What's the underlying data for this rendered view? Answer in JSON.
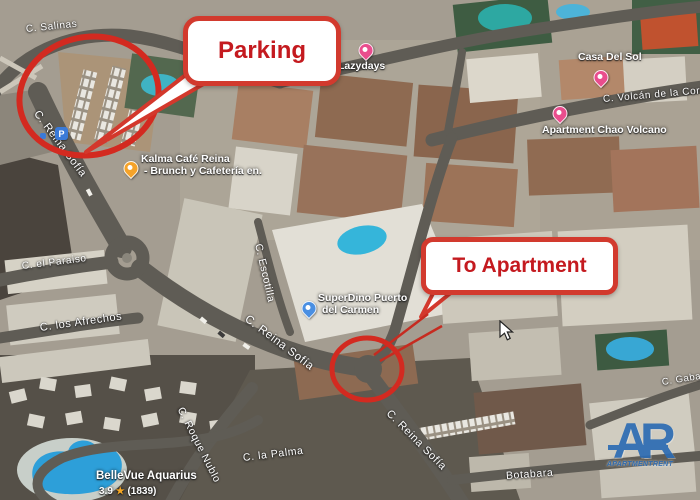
{
  "map": {
    "streets": [
      {
        "name": "C. Salinas"
      },
      {
        "name": "C. Reina Sofía"
      },
      {
        "name": "C. el Paraiso"
      },
      {
        "name": "C. los Afrechos"
      },
      {
        "name": "C. Escotilla"
      },
      {
        "name": "C. Reina Sofía"
      },
      {
        "name": "C. Volcán de la Corona"
      },
      {
        "name": "C. Roque Nublo"
      },
      {
        "name": "C. la Palma"
      },
      {
        "name": "C. Reina Sofía"
      },
      {
        "name": "Botabara"
      },
      {
        "name": "C. Gabarra"
      }
    ],
    "pois": [
      {
        "name": "Lazydays"
      },
      {
        "name": "Casa Del Sol"
      },
      {
        "name": "Apartment Chao Volcano"
      },
      {
        "name": "Kalma Café Reina",
        "line2": "- Brunch y Cafetería en."
      },
      {
        "name": "SuperDino Puerto",
        "line2": "del Carmen"
      },
      {
        "name": "BelleVue Aquarius",
        "rating": "3.9",
        "star": "★",
        "reviews": "(1839)"
      }
    ],
    "badges": {
      "parking": "P"
    }
  },
  "annotations": {
    "parking_callout": "Parking",
    "apartment_callout": "To Apartment"
  },
  "logo": {
    "letters": "AR",
    "subtext": "APARTMENTRENT"
  },
  "colors": {
    "annotation_red": "#d32a20",
    "callout_border": "#d23a2e",
    "callout_text": "#c41a1f",
    "pin_pink": "#e94d8d",
    "pin_amber": "#f5a32a",
    "pin_blue": "#4a8fe2",
    "logo_blue": "#2d6cb3",
    "pool_blue": "#35b0d8"
  }
}
